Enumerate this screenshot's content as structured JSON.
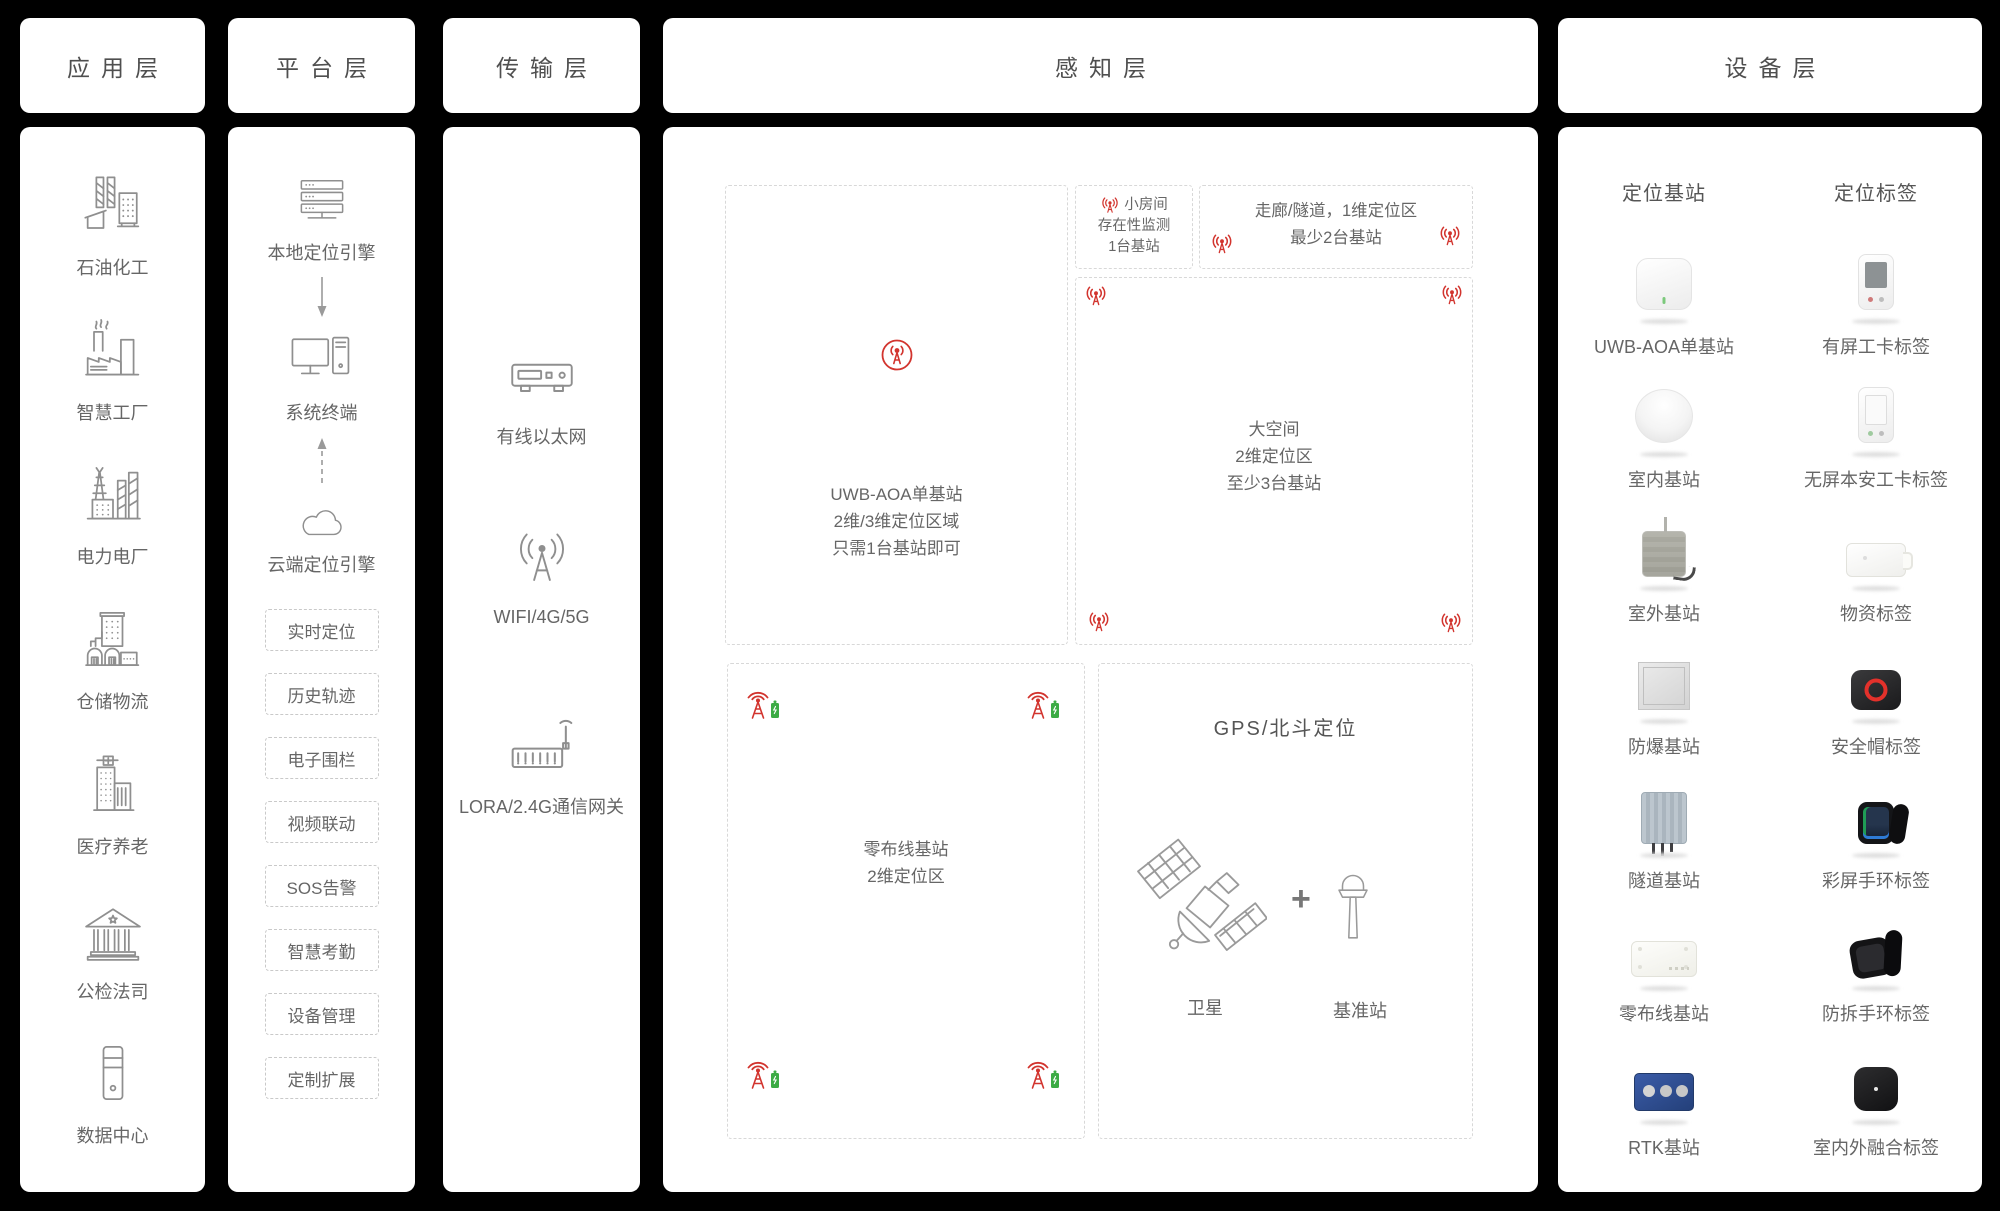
{
  "layers": {
    "application": "应用层",
    "platform": "平台层",
    "transmission": "传输层",
    "perception": "感知层",
    "device": "设备层"
  },
  "application": {
    "items": [
      {
        "label": "石油化工",
        "icon": "petrochemical-icon"
      },
      {
        "label": "智慧工厂",
        "icon": "smart-factory-icon"
      },
      {
        "label": "电力电厂",
        "icon": "power-plant-icon"
      },
      {
        "label": "仓储物流",
        "icon": "warehouse-logistics-icon"
      },
      {
        "label": "医疗养老",
        "icon": "medical-eldercare-icon"
      },
      {
        "label": "公检法司",
        "icon": "justice-court-icon"
      },
      {
        "label": "数据中心",
        "icon": "data-center-icon"
      }
    ]
  },
  "platform": {
    "local_engine": "本地定位引擎",
    "terminal": "系统终端",
    "cloud_engine": "云端定位引擎",
    "features": [
      {
        "label": "实时定位"
      },
      {
        "label": "历史轨迹"
      },
      {
        "label": "电子围栏"
      },
      {
        "label": "视频联动"
      },
      {
        "label": "SOS告警"
      },
      {
        "label": "智慧考勤"
      },
      {
        "label": "设备管理"
      },
      {
        "label": "定制扩展"
      }
    ]
  },
  "transmission": {
    "items": [
      {
        "label": "有线以太网",
        "icon": "ethernet-switch-icon"
      },
      {
        "label": "WIFI/4G/5G",
        "icon": "wifi-antenna-icon"
      },
      {
        "label": "LORA/2.4G通信网关",
        "icon": "lora-gateway-icon"
      }
    ]
  },
  "perception": {
    "uwb_zone": {
      "line1": "UWB-AOA单基站",
      "line2": "2维/3维定位区域",
      "line3": "只需1台基站即可"
    },
    "small_room_zone": {
      "line1": "小房间",
      "line2": "存在性监测",
      "line3": "1台基站"
    },
    "corridor_zone": {
      "line1": "走廊/隧道，1维定位区",
      "line2": "最少2台基站"
    },
    "large_space_zone": {
      "line1": "大空间",
      "line2": "2维定位区",
      "line3": "至少3台基站"
    },
    "zero_wiring_zone": {
      "line1": "零布线基站",
      "line2": "2维定位区"
    },
    "gps_zone": {
      "title": "GPS/北斗定位",
      "satellite_label": "卫星",
      "plus": "+",
      "base_station_label": "基准站"
    }
  },
  "device": {
    "base_column_title": "定位基站",
    "tag_column_title": "定位标签",
    "rows": [
      {
        "base": "UWB-AOA单基站",
        "tag": "有屏工卡标签"
      },
      {
        "base": "室内基站",
        "tag": "无屏本安工卡标签"
      },
      {
        "base": "室外基站",
        "tag": "物资标签"
      },
      {
        "base": "防爆基站",
        "tag": "安全帽标签"
      },
      {
        "base": "隧道基站",
        "tag": "彩屏手环标签"
      },
      {
        "base": "零布线基站",
        "tag": "防拆手环标签"
      },
      {
        "base": "RTK基站",
        "tag": "室内外融合标签"
      }
    ]
  },
  "colors": {
    "background": "#000000",
    "panel": "#ffffff",
    "text": "#666666",
    "accent_red": "#d2342e",
    "battery_green": "#3cab44"
  }
}
